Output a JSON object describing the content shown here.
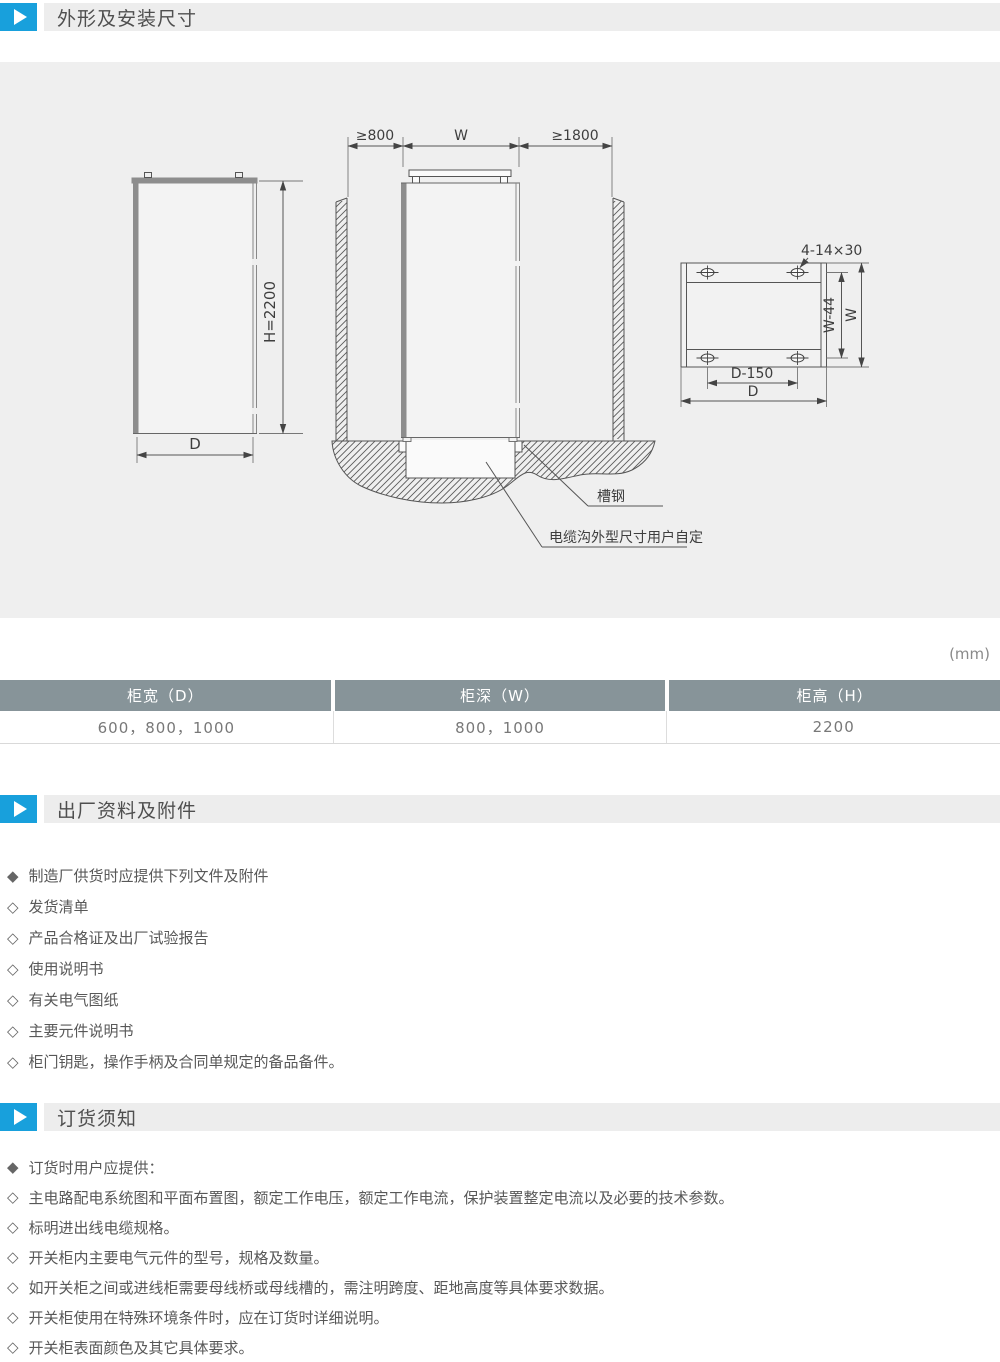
{
  "page": {
    "unit_label": "(mm)"
  },
  "colors": {
    "accent": "#18a0dc",
    "table_header": "#879499",
    "drawing_bg": "#efefef"
  },
  "sections": [
    {
      "title": "外形及安装尺寸"
    },
    {
      "title": "出厂资料及附件"
    },
    {
      "title": "订货须知"
    }
  ],
  "table": {
    "headers": [
      "柜宽（D）",
      "柜深（W）",
      "柜高（H）"
    ],
    "row": [
      "600，800，1000",
      "800，1000",
      "2200"
    ]
  },
  "factory_docs": {
    "items": [
      {
        "bullet": "◆",
        "text": "制造厂供货时应提供下列文件及附件"
      },
      {
        "bullet": "◇",
        "text": "发货清单"
      },
      {
        "bullet": "◇",
        "text": "产品合格证及出厂试验报告"
      },
      {
        "bullet": "◇",
        "text": "使用说明书"
      },
      {
        "bullet": "◇",
        "text": "有关电气图纸"
      },
      {
        "bullet": "◇",
        "text": "主要元件说明书"
      },
      {
        "bullet": "◇",
        "text": "柜门钥匙，操作手柄及合同单规定的备品备件。"
      }
    ]
  },
  "ordering_notes": {
    "items": [
      {
        "bullet": "◆",
        "text": "订货时用户应提供："
      },
      {
        "bullet": "◇",
        "text": "主电路配电系统图和平面布置图，额定工作电压，额定工作电流，保护装置整定电流以及必要的技术参数。"
      },
      {
        "bullet": "◇",
        "text": "标明进出线电缆规格。"
      },
      {
        "bullet": "◇",
        "text": "开关柜内主要电气元件的型号，规格及数量。"
      },
      {
        "bullet": "◇",
        "text": "如开关柜之间或进线柜需要母线桥或母线槽的，需注明跨度、距地高度等具体要求数据。"
      },
      {
        "bullet": "◇",
        "text": "开关柜使用在特殊环境条件时，应在订货时详细说明。"
      },
      {
        "bullet": "◇",
        "text": "开关柜表面颜色及其它具体要求。"
      }
    ]
  },
  "diagram": {
    "gap_left": "≥800",
    "cab_width": "W",
    "gap_right": "≥1800",
    "height": "H=2200",
    "depth": "D",
    "channel_steel": "槽钢",
    "cable_note": "电缆沟外型尺寸用户自定",
    "holes": "4-14×30",
    "plan_w44": "W-44",
    "plan_w": "W",
    "plan_d150": "D-150",
    "plan_d": "D"
  }
}
